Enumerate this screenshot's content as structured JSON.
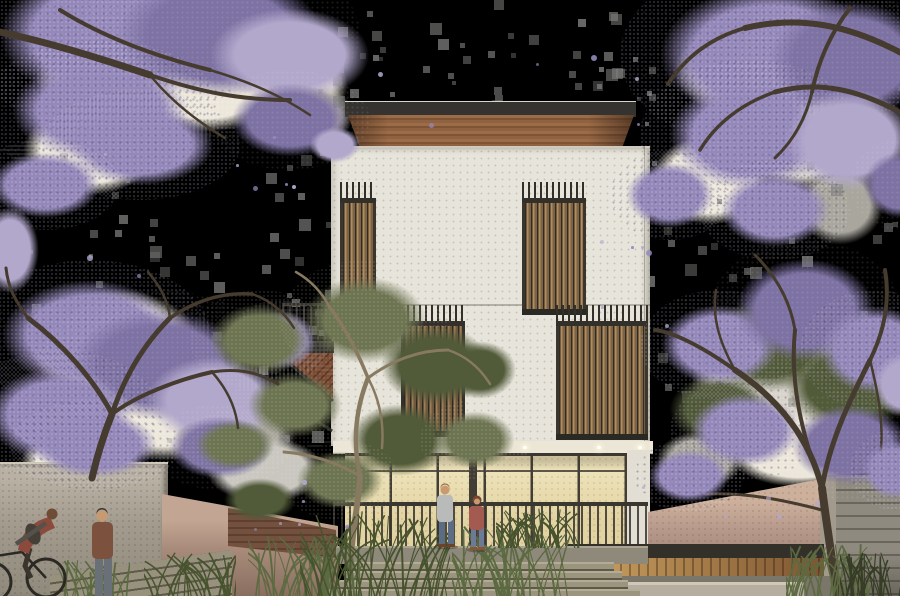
{
  "meta": {
    "kind": "architectural-illustration",
    "subject": "Three-storey modern house with timber slat screens, framed by blooming jacaranda trees, entry stair with grasses, cyclist and pedestrians in foreground",
    "canvas": {
      "width": 900,
      "height": 596
    },
    "background": "transparent (black) with gray compression speckles"
  },
  "scene": {
    "elements": [
      "jacaranda-canopy-top-left",
      "jacaranda-tree-left",
      "jacaranda-canopy-top-right",
      "jacaranda-tree-right",
      "house",
      "flat-roof",
      "timber-fascia",
      "slat-screen-upper-left",
      "slat-screen-upper-right",
      "slat-window-mid-left",
      "slat-screen-mid-right",
      "side-balcony",
      "entry-soffit-downlights",
      "lit-glazed-ground-floor",
      "entry-railing",
      "entry-stair",
      "eucalyptus-tree",
      "left-concrete-wall",
      "warm-retaining-walls",
      "timber-planter-wall",
      "right-fence",
      "grass-clumps",
      "man-at-entry",
      "woman-at-entry",
      "pedestrian-left",
      "cyclist-left"
    ]
  },
  "palette": {
    "black": "#000000",
    "paper": "#ece7da",
    "sky-gray": "#a9a69e",
    "street-sky": "#c9c7c0",
    "purple": "#9488ba",
    "purple-d": "#7d72a3",
    "purple-l": "#b2a8cc",
    "branch": "#453b2e",
    "facade": "#e7e4db",
    "roof": "#34332f",
    "fascia-a": "#9c6b48",
    "fascia-b": "#7e5434",
    "slat-a": "#b08c5e",
    "slat-b": "#7d6243",
    "slat-gap": "#33302a",
    "glaz-a": "#f0e6c0",
    "glaz-b": "#e2d3a2",
    "mullion": "#433e35",
    "rail": "#3a3731",
    "soffit": "#ece6d6",
    "recess": "#333029",
    "cap-wall": "#b5aea0",
    "lower-gray": "#7b766a",
    "post": "#a29a8d",
    "fence": "#8f8a7f",
    "fence-line": "#6b665c",
    "wood-a": "#caa05f",
    "wood-b": "#7d5531",
    "grass-a": "#5c6a41",
    "grass-b": "#47532e",
    "grass-dark": "#363d26",
    "euc-a": "#6d7452",
    "euc-b": "#515a39",
    "euc-trunk": "#877a60",
    "skin": "#c89a72",
    "skin-dark": "#6e4c36",
    "hair-a": "#8a5f3b",
    "hair-b": "#7a4631",
    "man-shirt": "#b8bbba",
    "man-jeans": "#5d6c85",
    "woman-top": "#a35a51",
    "woman-jeans": "#6b7b97",
    "ped-jacket": "#7c523f",
    "ped-pants": "#697077",
    "cyc-jacket": "#8c4a3c",
    "cyc-sleeve": "#55504a",
    "backpack": "#443f37",
    "bike": "#2b2924"
  },
  "effects": {
    "seed": 42,
    "speckle_count": 200,
    "petal_count": 36
  }
}
